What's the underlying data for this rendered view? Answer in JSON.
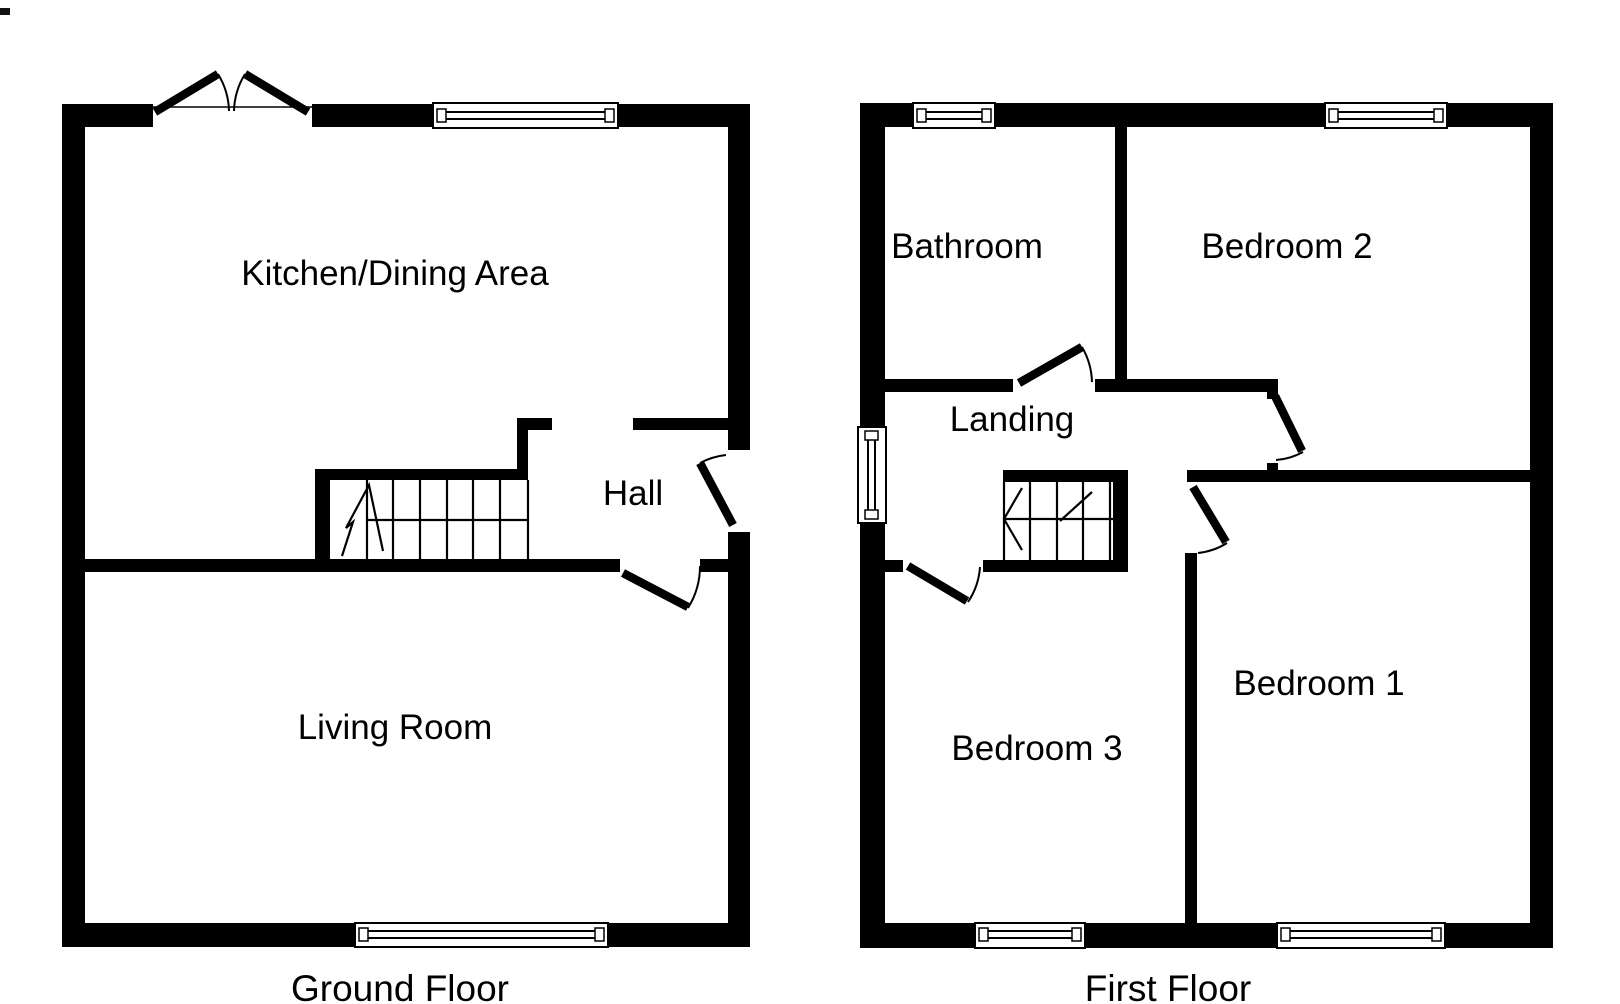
{
  "colors": {
    "background": "#ffffff",
    "walls": "#000000",
    "text": "#000000"
  },
  "ground_floor": {
    "title": "Ground Floor",
    "rooms": [
      {
        "label": "Kitchen/Dining Area"
      },
      {
        "label": "Hall"
      },
      {
        "label": "Living Room"
      }
    ]
  },
  "first_floor": {
    "title": "First Floor",
    "rooms": [
      {
        "label": "Bathroom"
      },
      {
        "label": "Bedroom 2"
      },
      {
        "label": "Landing"
      },
      {
        "label": "Bedroom 3"
      },
      {
        "label": "Bedroom 1"
      }
    ]
  }
}
